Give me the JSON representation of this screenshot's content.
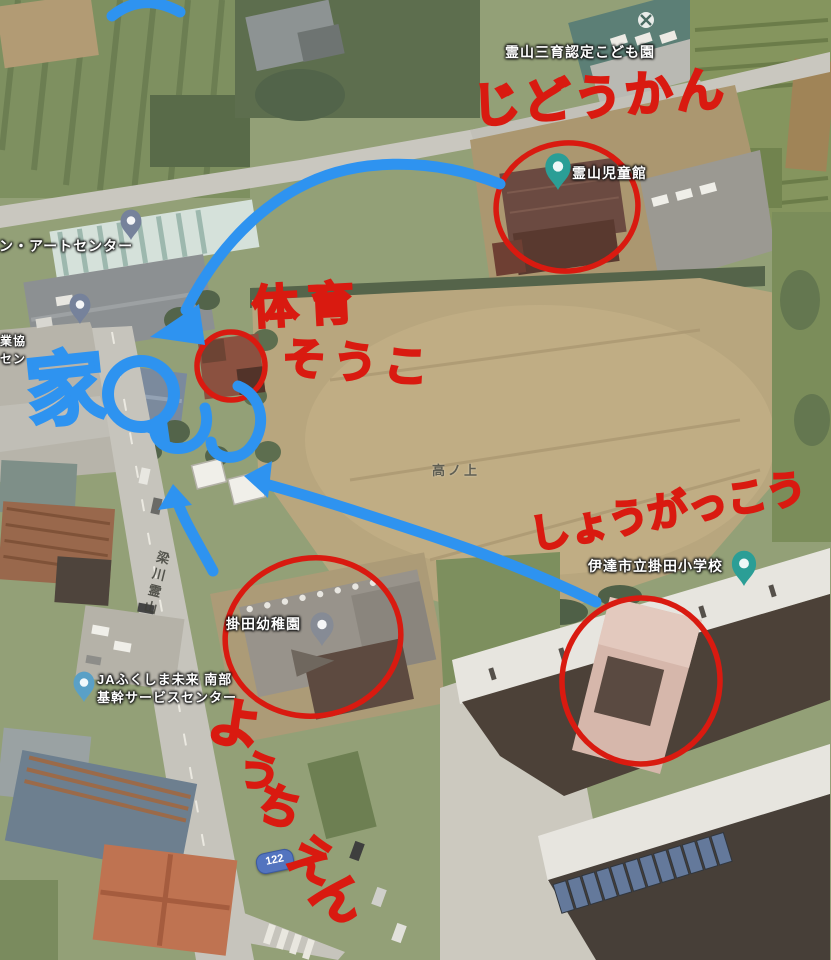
{
  "labels": {
    "kodomoen": "霊山三育認定こども園",
    "jidokan": "霊山児童館",
    "art_center": "サン・アートセンター",
    "coop_fragment_line1": "業協",
    "coop_fragment_line2": "セン",
    "field_name": "高ノ上",
    "elementary_school": "伊達市立掛田小学校",
    "kindergarten": "掛田幼稚園",
    "ja_center_line1": "JAふくしま未来 南部",
    "ja_center_line2": "基幹サービスセンター",
    "route_number": "122",
    "road_name": "梁川霊山"
  },
  "annotations": {
    "text_jidokan": "じどうかん",
    "text_gym_line1": "体育",
    "text_gym_line2": "そうこ",
    "text_elementary": "しょうがっこう",
    "text_kindergarten_chars": [
      "よ",
      "う",
      "ち",
      "え",
      "ん"
    ],
    "text_house": "家"
  },
  "colors": {
    "ink_red": "#d91a10",
    "ink_blue": "#2e93f0",
    "pin_teal": "#2b9e96",
    "pin_gray": "#868b95",
    "pin_slate": "#76829b",
    "pin_blue": "#5aa0c6",
    "route_badge_blue": "#5374bf"
  },
  "icons": {
    "place_pin": "teardrop-marker",
    "roof_logo": "white-circle-cross"
  }
}
